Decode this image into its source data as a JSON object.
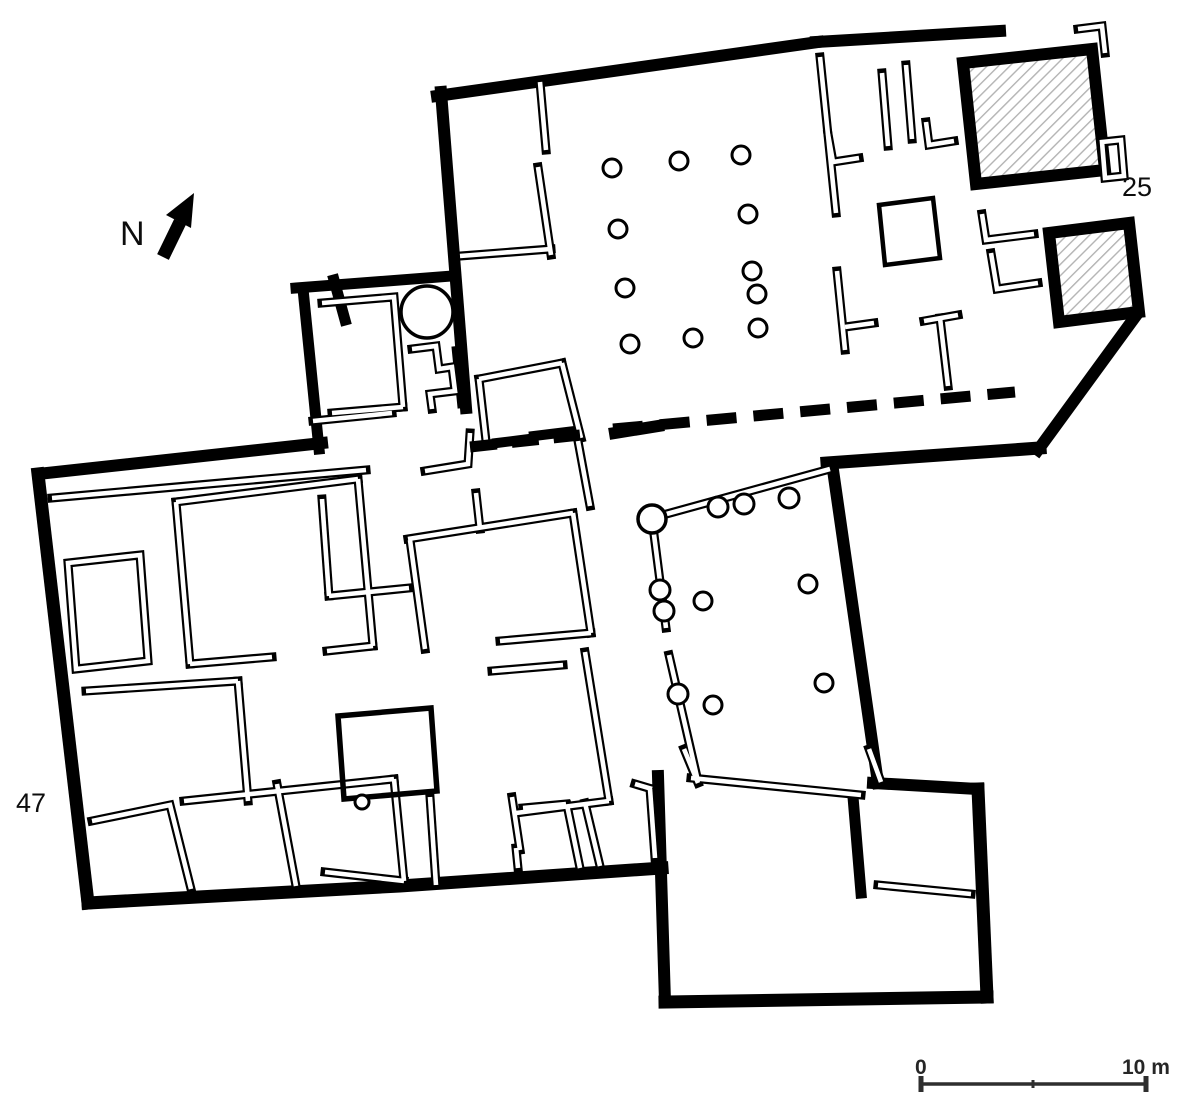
{
  "meta": {
    "description": "Archaeological building floor plan with hatched rooms, colonnaded courts, north arrow and scale bar"
  },
  "labels": {
    "north": "N",
    "unit_25": "25",
    "unit_47": "47"
  },
  "scale_bar": {
    "zero": "0",
    "max": "10 m"
  },
  "colors": {
    "wall": "#000000",
    "background": "#ffffff",
    "hatch_line": "#b3b3b3",
    "scale_bar": "#2e2e2e"
  },
  "icons": {
    "north_arrow": "north-arrow-icon"
  }
}
